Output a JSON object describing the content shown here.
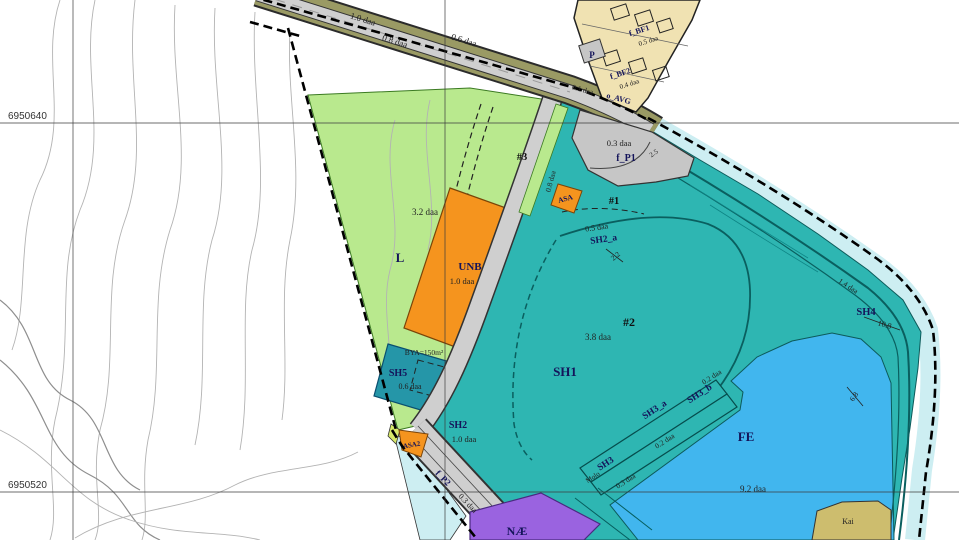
{
  "coordinates": {
    "row1": "6950640",
    "row2": "6950520"
  },
  "roads": {
    "seg1_area": "1.0 daa",
    "seg2_area": "0.8 daa",
    "seg3_area": "0.6 daa",
    "sliver_area": "0.8 daa",
    "avg_code": "o_AVG",
    "avg_area": "0.1 daa"
  },
  "zones": {
    "l": {
      "code": "L",
      "area": "3.2 daa"
    },
    "unb": {
      "code": "UNB",
      "area": "1.0 daa"
    },
    "asa": {
      "code": "ASA"
    },
    "asa2": {
      "code": "ASA2"
    },
    "p": {
      "code": "P"
    },
    "bf1": {
      "code": "f_BF1",
      "area": "0.5 daa"
    },
    "bf2": {
      "code": "f_BF2",
      "area": "0.4 daa"
    },
    "fp1": {
      "code": "f_P1",
      "area": "0.3 daa"
    },
    "fp2": {
      "code": "f_P2",
      "area": "0.3 daa"
    },
    "sh1": {
      "code": "SH1"
    },
    "sh2a": {
      "code": "SH2_a",
      "area": "0.5 daa"
    },
    "sh2": {
      "code": "SH2",
      "area": "1.0 daa"
    },
    "sh3": {
      "code": "SH3",
      "note": "Molo",
      "area": "0.3 daa"
    },
    "sh3a": {
      "code": "SH3_a",
      "area": "0.2 daa"
    },
    "sh3b": {
      "code": "SH3_b",
      "area": "0.2 daa"
    },
    "sh4": {
      "code": "SH4",
      "dim": "10.8",
      "area": "1.4 daa"
    },
    "sh5": {
      "code": "SH5",
      "area": "0.6 daa",
      "bya": "BYA=150m²"
    },
    "fe": {
      "code": "FE",
      "area": "9.2 daa"
    },
    "nae": {
      "code": "NÆ"
    },
    "kai": {
      "code": "Kai"
    }
  },
  "markers": {
    "m1": "#1",
    "m2": "#2",
    "m2_area": "3.8 daa",
    "m3": "#3",
    "dim_22": "2.2",
    "dim_25": "2.5",
    "dim_68": "6.8"
  },
  "colors": {
    "green": "#b9e98e",
    "orange": "#f5941e",
    "teal": "#2eb6b2",
    "tealDark": "#2596a8",
    "blue": "#41b6ee",
    "purple": "#9a63e0",
    "paleCyan": "#cdeef2",
    "roadOlive": "#9a9a64",
    "roadGray": "#cfcfcf",
    "parkingGray": "#c6c6c6",
    "houseTan": "#f0e2b2",
    "kaiTan": "#cdbd6e",
    "labelNavy": "#14145a"
  }
}
